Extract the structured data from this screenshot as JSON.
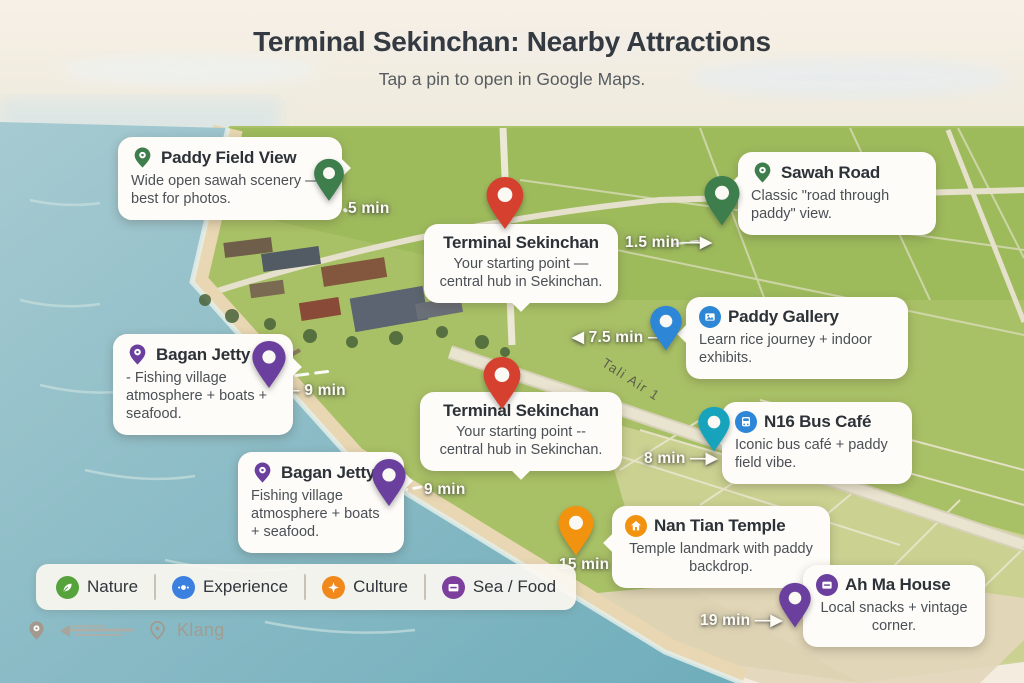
{
  "header": {
    "title": "Terminal Sekinchan: Nearby Attractions",
    "subtitle": "Tap a pin to open in Google Maps."
  },
  "road_label": "Tali Air 1",
  "cards": [
    {
      "id": "paddy-field-view",
      "title": "Paddy Field View",
      "body": "Wide open sawah scenery — best for photos.",
      "time": "5 min",
      "category": "nature",
      "pin_color": "#3e7d4c"
    },
    {
      "id": "sawah-road",
      "title": "Sawah Road",
      "body": "Classic \"road through paddy\" view.",
      "time": "1.5 min —▶",
      "category": "nature",
      "pin_color": "#3e7d4c"
    },
    {
      "id": "terminal-sekinchan-top",
      "title": "Terminal Sekinchan",
      "body": "Your starting point — central hub in Sekinchan.",
      "time": "",
      "category": "start",
      "pin_color": "#d6412f"
    },
    {
      "id": "paddy-gallery",
      "title": "Paddy Gallery",
      "body": "Learn rice journey + indoor exhibits.",
      "time": "◀ 7.5 min —",
      "category": "experience",
      "pin_color": "#2e86d6"
    },
    {
      "id": "bagan-jetty-1",
      "title": "Bagan Jetty",
      "body": "- Fishing village atmosphere + boats + seafood.",
      "time": "◀— 9 min",
      "category": "sea-food",
      "pin_color": "#6a3f9e"
    },
    {
      "id": "terminal-sekinchan-mid",
      "title": "Terminal Sekinchan",
      "body": "Your starting point -- central hub in Sekinchan.",
      "time": "",
      "category": "start",
      "pin_color": "#d6412f"
    },
    {
      "id": "n16-bus-cafe",
      "title": "N16 Bus Café",
      "body": "Iconic bus café + paddy field vibe.",
      "time": "8 min —▶",
      "category": "experience",
      "pin_color": "#17a3bc"
    },
    {
      "id": "bagan-jetty-2",
      "title": "Bagan Jetty",
      "body": "Fishing village atmosphere + boats + seafood.",
      "time": "9 min",
      "category": "sea-food",
      "pin_color": "#6a3f9e"
    },
    {
      "id": "nan-tian-temple",
      "title": "Nan Tian Temple",
      "body": "Temple landmark with paddy backdrop.",
      "time": "15 min",
      "category": "culture",
      "pin_color": "#f2930f"
    },
    {
      "id": "ah-ma-house",
      "title": "Ah Ma House",
      "body": "Local snacks + vintage corner.",
      "time": "19 min —▶",
      "category": "sea-food",
      "pin_color": "#6a3f9e"
    }
  ],
  "legend": {
    "items": [
      {
        "label": "Nature",
        "color": "#56a33c",
        "icon": "leaf-icon"
      },
      {
        "label": "Experience",
        "color": "#3b7fe0",
        "icon": "compass-dots-icon"
      },
      {
        "label": "Culture",
        "color": "#f0881c",
        "icon": "sparkle-icon"
      },
      {
        "label": "Sea / Food",
        "color": "#7d3f9e",
        "icon": "storefront-card-icon"
      }
    ]
  },
  "footer": {
    "place": "Klang"
  },
  "icons": {
    "map_pin": "teardrop map pin",
    "gallery": "picture-frame",
    "bus": "bus",
    "temple": "house",
    "shop": "storefront-card"
  },
  "colors": {
    "start_pin": "#d6412f",
    "nature_pin": "#3e7d4c",
    "experience_pin_blue": "#2e86d6",
    "experience_pin_teal": "#17a3bc",
    "sea_food_pin": "#6a3f9e",
    "culture_pin": "#f2930f",
    "card_background": "#fdfcf8",
    "sea": "#74b1bd",
    "paddy_field": "#a9c166"
  }
}
